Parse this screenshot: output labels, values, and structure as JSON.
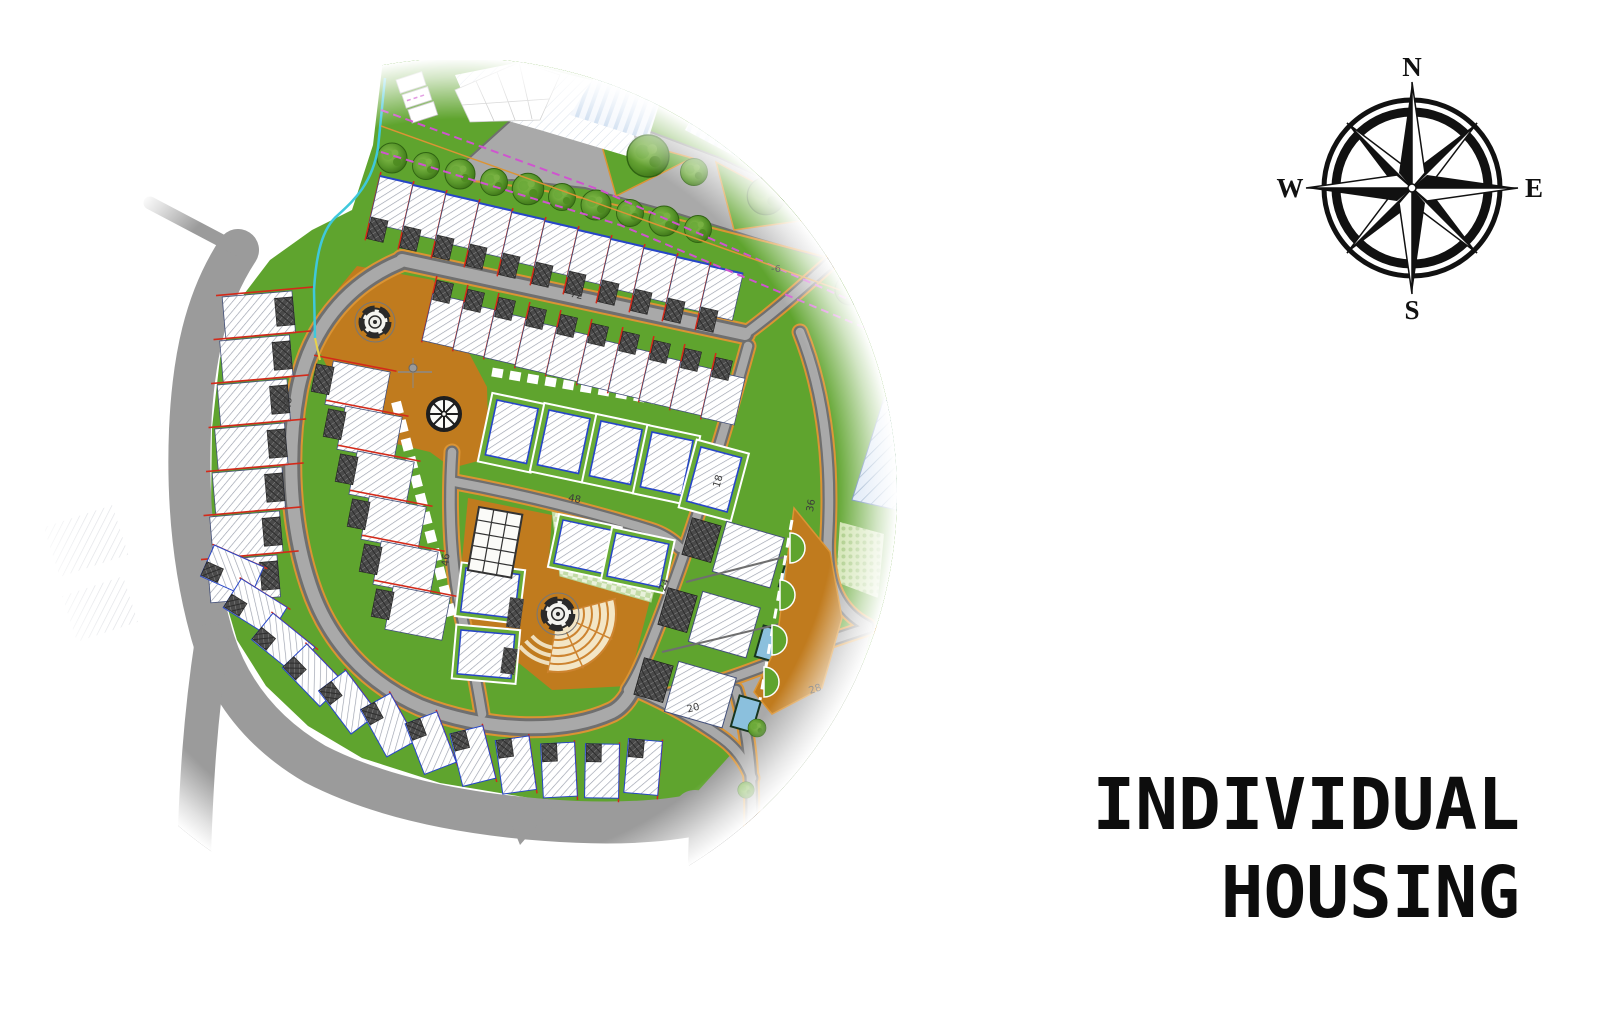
{
  "page": {
    "background": "#ffffff",
    "width": 1599,
    "height": 1030
  },
  "title": {
    "line1": "INDIVIDUAL",
    "line2": "HOUSING"
  },
  "compass": {
    "north": "N",
    "east": "E",
    "south": "S",
    "west": "W"
  },
  "site_plan": {
    "description": "Circular aerial masterplan rendering of an individual housing estate with loop road, row houses, villas, central plaza, fountains and amphitheater steps",
    "road_labels": [
      {
        "id": "road-72",
        "text": "72"
      },
      {
        "id": "road-48-west",
        "text": "48"
      },
      {
        "id": "road-48-central",
        "text": "48"
      },
      {
        "id": "road-46",
        "text": "46"
      },
      {
        "id": "road-18",
        "text": "18"
      },
      {
        "id": "road-24",
        "text": "24"
      },
      {
        "id": "road-36",
        "text": "36"
      },
      {
        "id": "road-20",
        "text": "20"
      },
      {
        "id": "road-28",
        "text": "28"
      },
      {
        "id": "marker-minus-6",
        "text": "-6"
      }
    ],
    "colors": {
      "grass": "#5fa42e",
      "lawn": "#68ac35",
      "asphalt": "#a9a9a9",
      "curb": "#6f6f6f",
      "perimeter_road": "#9b9b9b",
      "plaza": "#c07b1e",
      "road_edge_accent": "#db9434",
      "parcel_line": "#d32a1a",
      "utility_line": "#cf54cf",
      "stream": "#3fc8dc",
      "pool": "#8bc0dd",
      "roof_hatch": "#4a4a4a",
      "amphitheater_steps": "#f3e6c6",
      "water_zone_hatch": "#d4e2f4"
    },
    "features": [
      "row houses",
      "detached villas",
      "central plaza",
      "fountain roundabouts",
      "amphitheater steps",
      "swimming pools",
      "tree-lined street",
      "glass canopy building",
      "stream line",
      "compass rose"
    ]
  }
}
